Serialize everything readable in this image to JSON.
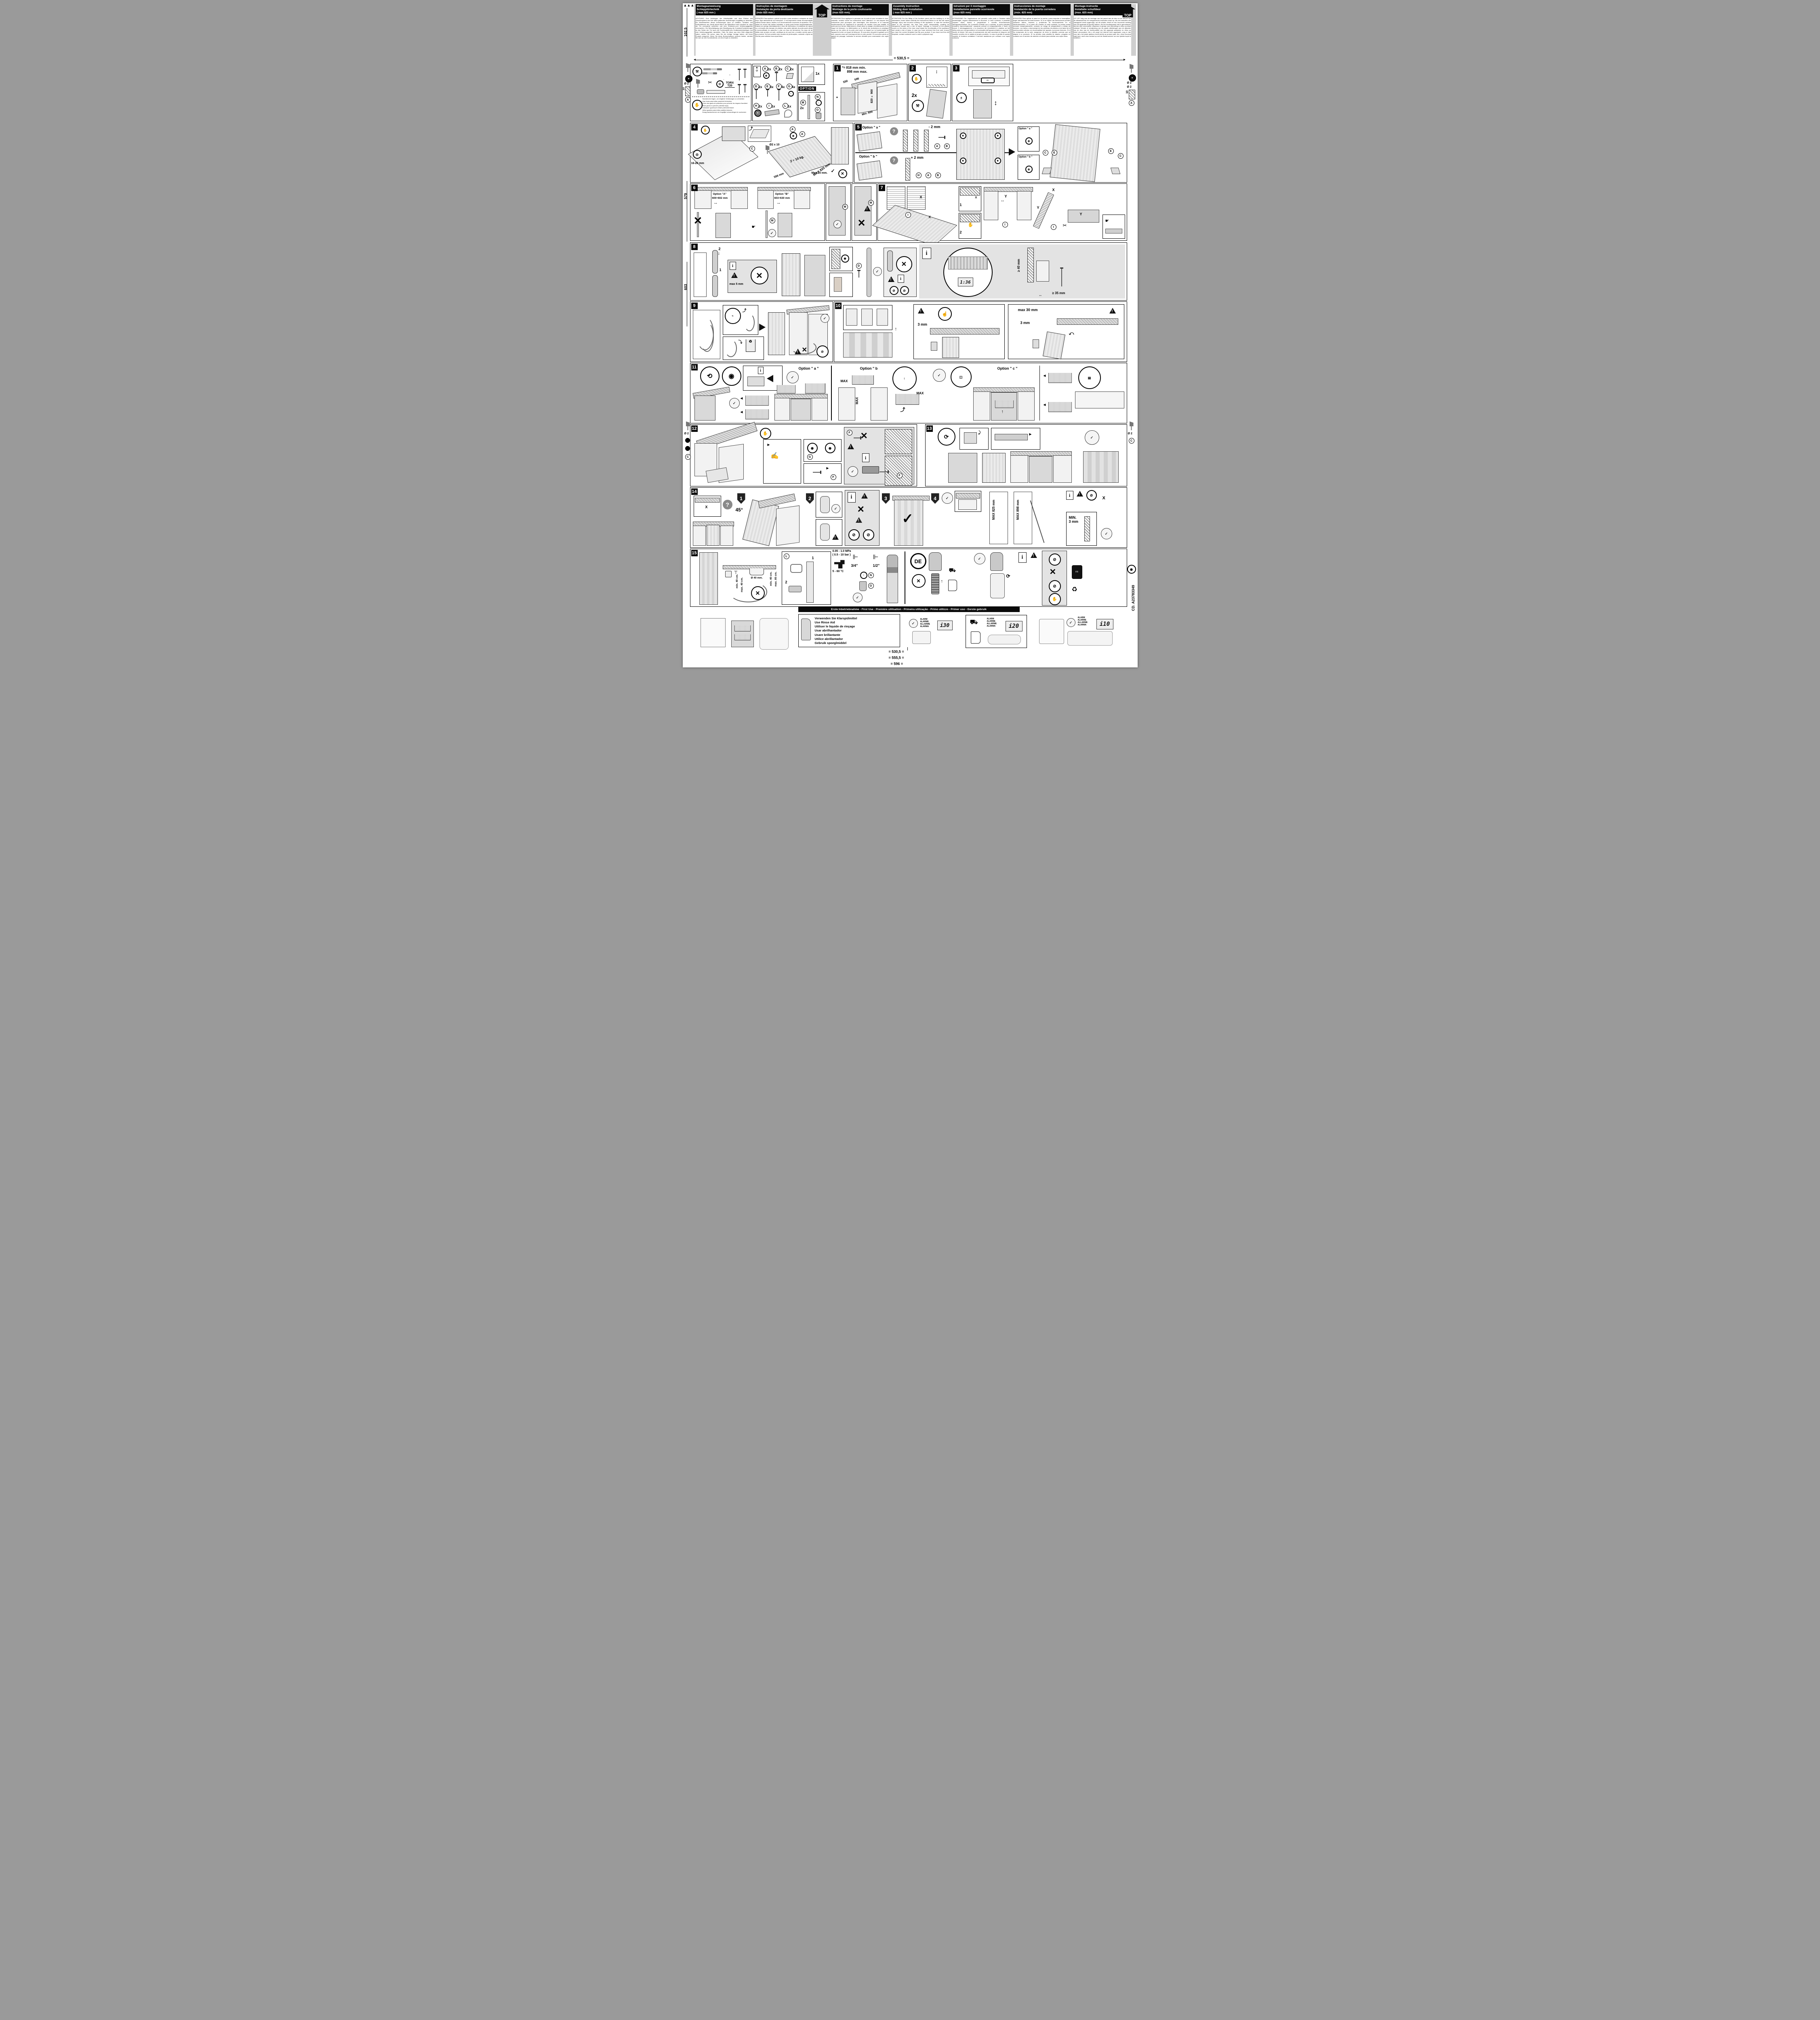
{
  "page": {
    "top_label": "TOP",
    "torx_line1": "TORX",
    "torx_line2": "T20",
    "top_dim": "530,5",
    "eq": "=",
    "first_use": "Erste Inbetriebnahme - First Use - Première utilisation - Primeira utilização - Primo utilizzo - Primer uso - Eerste gebruik",
    "code": "CD. A23783349",
    "bottom_dims": [
      "530,5",
      "555,5",
      "596"
    ],
    "left_margin": {
      "d_top": "102,5",
      "d_mid": "579",
      "d_low": "603",
      "dia": "Ø 2",
      "hole_depth": "10",
      "part_a": "A",
      "part_c": "C"
    },
    "right_margin": {
      "dia": "Ø 2",
      "dia2": "Ø 2",
      "hole_depth": "10",
      "part_a": "A",
      "part_c": "C"
    }
  },
  "icons": {
    "check": "✓",
    "cross": "✕",
    "question": "?",
    "info": "i",
    "star": "*",
    "hand": "☛",
    "plus": "+",
    "minus": "-",
    "arrow_lr": "↔",
    "arrow_ud": "↕",
    "recycle": "♻",
    "scissors": "✂",
    "wrench": "🔧"
  },
  "header": {
    "columns": [
      {
        "title": [
          "Montageanweisung",
          "Schlepptürtechnik",
          "( max 825 mm )"
        ],
        "body": "ACHTUNG! Zum Anbringen der Arbeitsplatte und dem Einbau des Geschirrspülers sind die dafür geltenden Anweisungen sorgfältig zu beachten. Ein Nichtbeachten dieser Anweisungen kann zu Unfällen, Schäden und Fehlfunktionen am Gerät fuhren.Wenn die Möbelfront nicht montiert ist, kann die Tür unerwartet schließen und eine Einklemm-und Verletzungsgefahr verursachen. Die Beschädigung oder Beseitigung der Kunststoff abdeckungen an den Seiten der Tür kann die Funktionalität des Gerätsbeeinträchtigen und eine Verletzungsgefahr darstellen. Falls Sie diese aus dem Web abgerufen haben, stellen Sie sicher, dass Sie die richtige Vorlage haben, die Ihrem Produkt entspricht. Wenn Sie diese Bohrschablone verloren haben, wenden Sie sich an den Kundendienst, um eine Kopie zu bestellen."
      },
      {
        "title": [
          "Instruções de montagem",
          "Instalação da porta deslizante",
          "(máx 825 mm )"
        ],
        "body": "ATENÇÃO! Para aplicar o painel na porta e para encaixar a máquina de lavar loiça, siga atentamente as instruções. O incumprimento desta recomendação poderá causar danos, lesões e um funcionamento incorrecto do aparelho. Se o painel do móvel não estiver instalado, a porta pode fechar inesperadamente, criando um perigo deentalamento e risco de ferimentos. A existência de danos ou a remoção das tampas de plástico nas partes laterais da porta pode afetar a funcionalidade do aparelho e criar um risco de ferimentos. No caso de ter obtido este produto na web, certifique-se de que tem o modelo correto para o seu produto. Se tiver perdido este modelo de perfurações, contacte o Apoio ao Cliente para solicitar uma cópia física."
      },
      {
        "title": [
          "Instructions de montage",
          "Montage de la porte coulissante",
          "(max 825 mm)."
        ],
        "body": "ATTENTION! Pour appliquer le panneau sur la porte et pour encastrer le lave-vaisselle, veuillez suivre les instructions avec attention. Le non-respect des instructions peut provoquer des dommages, des blessures et le mauvais fonctionnement de l'appareil.Si le panneau du meuble n'est pas installé, la porte peut se fermer inopinément, créant ainsi un danger d'entraînement et un risque de blessure. La détérioration ou le retrait des protections en plastique situés sur les côtés de la porte peut avoir un impact sur la fonctionnalité de l'appareil et créer un risque de blessure. Si vous avez récupéré le gabarit sur le web, assurez-vous qu'il correspond bien à votre produit. Si vous avez perdu ce gabarit de perçage, contactez le service clientèle pour commander une copie papier."
      },
      {
        "title": [
          "Assembly Instruction",
          "Sliding door installation",
          "( max 825 mm )"
        ],
        "body": "ATTENTION! For the fitting of the furniture panel and the building in of the dishwasher, lease follow carefully the instructions.Failure to do this will cause damage, injury and incorrect working of the appliance. In case the furniture panel is not mounted, the door may close unexpectedly, creating an entrapment hazard and a risk of injury. Damage or removal of the plastic covers on the sides of the door may impact the functionality of the appliance and create a risk of injury. In case you have retrieved this from web, ensure you have the correct template that fits your product. If you have lost this drill template, contact customer care to order a physical copy."
      },
      {
        "title": [
          "Istruzioni per il montaggio",
          "Installazione pannello scorrevole",
          "(max 825 mm)"
        ],
        "body": "ATTENZIONE! Per l'applicazione del pannello sulla porta e l'incasso della lavastoviglie, seguire attentamente le istruzioni. In caso contrario, è possibile causare danni, lesioni e pregiudicare il corretto funzionamento dell'apparecchiatura. Se il pannello frontale non è montato, la porta potrebbe chiudersi improvvisamente, causando pericoli di intrappolamento e rischi di lesioni. Il danneggiamento o la rimozione dei rivestimenti in plastica sui lati della porta può compromettere la funzionalità dell'apparecchiatura e causare il rischio di lesioni. Nel caso di scaricamento dal web accertarsi di disporre del modello corretto che si adatta al proprio prodotto. In caso di perdita di questo modello di foratura contattare il servizio assistenza per ordinare una copia cartacea."
      },
      {
        "title": [
          "Instrucciones de montaje",
          "Instalación de la puerta corredera",
          "(máx. 825 mm)"
        ],
        "body": "ATENCIÓN! Para aplicar el panel en la puerta y para empotrar el lavavajillas, seguir atentamente las instrucciones. Si no se siguen las instrucciones pueden causarse daños, lesiones y problemas de funcionamiento en el electrodoméstico. Si el panel del mueble no está montado, la puerta puede cerrarse inesperadamente, creando un riesgo de atrapamiento y riesgo de lesiones. Los daños o desmontaje de las cubiertas de plástico a los lados de la puerta pueden afectar a la funcionalidad del aparato y provocar lesiones. Si lo ha recuperado de la web, asegúrese de tener la plantilla correcta que se adapta a su producto. Si ha perdido esta plantilla de taladro, póngase en contacto con el servicio de atención al cliente para solicitar una copia física."
      },
      {
        "title": [
          "Montage-instructie",
          "Installatie schuifdeur",
          "(max. 825 mm)"
        ],
        "body": "LET OP! Volg voor de montage van het paneel aan de deur en de  inbouw van de afwasmachine de meegeleverde instructies exact op. Als de instructies niet nauwgezet wordt opgevolgd, zal dit schade, letsel en een incorrecte werking van het apparaat tot gevolg hebben. Als het meubelpaneel niet is gemonteerd, sluit de deur onverwacht, waardoor er gevaar voor beknelling en risico op letsel ontstaat. Schade of verwijdering van de plastic afdekkingen aan de zijkanten van de deur kan de functionaliteit van het apparaat aantasten en risico op letsel veroorzaken. Als u dit vanaf het internet hebt opgehaald, zorg er dan voor dat u het juiste sjabloon heeft dat bij uw product past. Als u deze boormal kwijt bent, neem dan contact op met de klantenservice om een fysieke kopie te bestellen."
      }
    ]
  },
  "tools": {
    "gloves": [
      "Handschuhe tragen, um mögliche Verletzungen zu vermeiden",
      "Usar luvas para evitar possíveis ferimentos",
      "Porter des gants de protection pour prévenir les risques d'accident",
      "Wear gloves to prevent potential injury",
      "Indossare i guanti per evitare potenziali lesioni",
      "Utilice guantes para evitar posibles lesiones",
      "Draag handschoenen om mogelijke verwondingen te voorkomen"
    ]
  },
  "parts": {
    "items": [
      {
        "id": "A",
        "qty": "2x"
      },
      {
        "id": "B",
        "qty": "2x"
      },
      {
        "id": "C",
        "qty": "2x"
      },
      {
        "id": "D",
        "qty": "2x"
      },
      {
        "id": "E",
        "qty": "8x"
      },
      {
        "id": "F",
        "qty": "4x"
      },
      {
        "id": "G",
        "qty": "4x"
      },
      {
        "id": "H",
        "qty": "2x"
      },
      {
        "id": "I",
        "qty": "1x"
      },
      {
        "id": "L",
        "qty": "1x"
      }
    ],
    "template_qty": "1x",
    "option_label": "OPTION",
    "option_m": "M",
    "option_m_qty": "2x",
    "option_n": "N",
    "option_o": "O"
  },
  "steps": {
    "s1": {
      "num": "1",
      "star": "*=",
      "min": "818 mm min.",
      "max": "898 mm max.",
      "w1": "550",
      "w2": "596",
      "h": "820 ÷ 900",
      "depth": "Min. 600",
      "star2": "*"
    },
    "s2": {
      "num": "2",
      "qty": "2x"
    },
    "s3": {
      "num": "3"
    },
    "s4": {
      "num": "4",
      "edge": "16-26 mm",
      "drill": "Ø2 x 10",
      "part_c": "C",
      "part_a": "A",
      "part_a2": "A",
      "weight": "2 ÷ 10 kg.",
      "w": "596 mm",
      "h": "MAX 825  mm",
      "screw": "Max 10 mm."
    },
    "s5": {
      "num": "5",
      "opt_a": "Option \" a \"",
      "minus": "- 2 mm",
      "pa": "A",
      "pb": "B",
      "opt_b": "Option \" b \"",
      "plus": "+ 2 mm",
      "ph": "H",
      "pa2": "A",
      "pb2": "B",
      "opt_a2": "Option \" a \"",
      "opt_b2": "Option \" b \"",
      "pc": "C",
      "pe": "E",
      "pe2": "E",
      "pc2": "C"
    },
    "s6": {
      "num": "6",
      "opt_a": "Option \"A\"",
      "range_a": "600÷602 mm",
      "opt_b": "Option \"B\"",
      "range_b": "603÷630 mm",
      "pm": "M",
      "pm2": "M",
      "pm3": "M"
    },
    "s7": {
      "num": "7",
      "x": "X",
      "y": "Y",
      "pi": "I",
      "n1": "1",
      "n2": "2",
      "x2": "X",
      "y2": "Y",
      "x3": "X",
      "y3": "Y",
      "x4": "X",
      "pi2": "I",
      "pi3": "I"
    },
    "s8": {
      "num": "8",
      "n1": "1",
      "n2": "2",
      "gap": "max 5 mm",
      "pd": "D",
      "pd2": "D",
      "display": "1:36",
      "h1": "≥ 40 mm",
      "h2": "≥ 35 mm"
    },
    "s9": {
      "num": "9"
    },
    "s10": {
      "num": "10",
      "g1": "3 mm",
      "g2": "max 30 mm",
      "g3": "3 mm"
    },
    "s11": {
      "num": "11",
      "opt_a": "Option \" a \"",
      "opt_b": "Option \" b",
      "opt_c": "Option \" c \"",
      "max1": "MAX",
      "max2": "MAX",
      "max3": "MAX"
    },
    "s12": {
      "num": "12",
      "pg": "G",
      "pf": "F",
      "pf2": "F",
      "pf3": "F"
    },
    "s13": {
      "num": "13"
    },
    "s14": {
      "num": "14",
      "angle": "45°",
      "x": "X",
      "x2": "X",
      "n1": "1",
      "n2": "2",
      "n3": "3",
      "n4": "4",
      "max825": "MAX 825 mm",
      "max898": "MAX 898 mm",
      "min3a": "MIN.",
      "min3b": "3 mm"
    },
    "s15": {
      "num": "15",
      "pl": "L",
      "n1": "1",
      "n2": "2",
      "min40": "min. 40 cm.",
      "max40": "max. 40 cm.",
      "min40b": "min. 40 cm.",
      "max85": "max. 85 cm.",
      "pressure": "0.05 - 1.0 MPa",
      "bar": "( 0.5 - 10 bar )",
      "temp": "5 - 60 °C",
      "dia40": "Ø 40 mm.",
      "t34": "3/4\"",
      "t12": "1/2\"",
      "pn": "N",
      "po": "O",
      "de": "DE"
    }
  },
  "bottom": {
    "rinse": [
      "Verwenden Sie Klarspülmittel",
      "Use Rinse Aid",
      "Utiliser le liquide de rinçage",
      "Usar abrilhantador",
      "Usare brillantante",
      "Utilice abrillantador",
      "Gebruik spoeglmiddel"
    ],
    "alarm_lines": [
      "ALARM",
      "ALARME",
      "ALLARME",
      "ALARMA"
    ],
    "codes": [
      "i30",
      "i20",
      "i10"
    ]
  }
}
